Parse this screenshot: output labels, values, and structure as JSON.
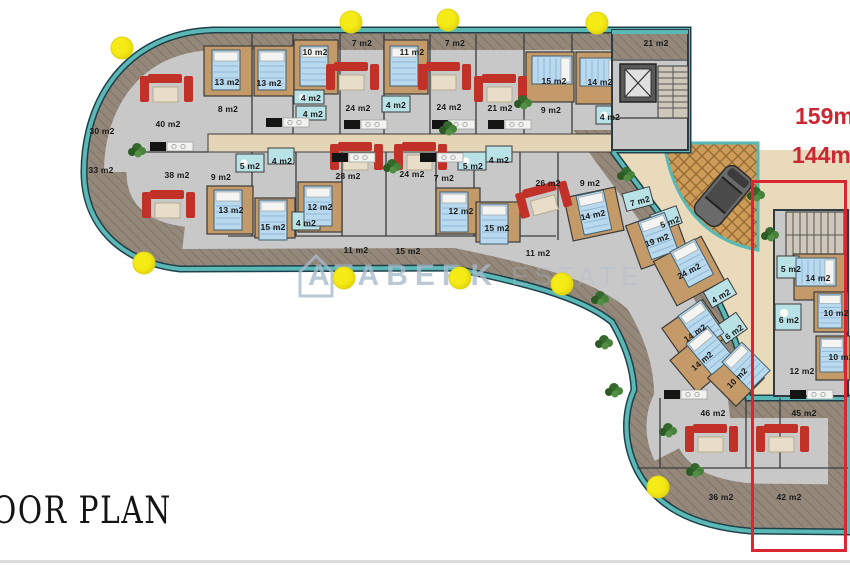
{
  "title": {
    "floor_plan": "OOR PLAN"
  },
  "watermark": {
    "brand": "ATABERK",
    "suffix": "ESTATE"
  },
  "highlight": {
    "area_line1": "159m",
    "area_line2": "144m"
  },
  "colors": {
    "teal_edge": "#5ab9b7",
    "dark_outline": "#2e3b42",
    "floor_grey": "#c8c8c8",
    "deck_wood": "#94887b",
    "room_wood": "#c49a68",
    "bath_cyan": "#b9e2e6",
    "pavement_beige": "#e9dabc",
    "court_pattern": "#cd9c58",
    "sofa_red": "#c23128",
    "dot_yellow": "#f5eb16",
    "highlight_red": "#da2630",
    "watermark_blue": "#a9bacd"
  },
  "rooms": [
    {
      "t": "30 m2",
      "x": 102,
      "y": 131
    },
    {
      "t": "33 m2",
      "x": 101,
      "y": 170
    },
    {
      "t": "7 m2",
      "x": 362,
      "y": 43
    },
    {
      "t": "7 m2",
      "x": 455,
      "y": 43
    },
    {
      "t": "21 m2",
      "x": 656,
      "y": 43
    },
    {
      "t": "11 m2",
      "x": 356,
      "y": 250
    },
    {
      "t": "15 m2",
      "x": 408,
      "y": 251
    },
    {
      "t": "11 m2",
      "x": 538,
      "y": 253
    },
    {
      "t": "36 m2",
      "x": 721,
      "y": 497
    },
    {
      "t": "42 m2",
      "x": 789,
      "y": 497
    },
    {
      "t": "40 m2",
      "x": 168,
      "y": 124
    },
    {
      "t": "13 m2",
      "x": 227,
      "y": 82
    },
    {
      "t": "13 m2",
      "x": 269,
      "y": 83
    },
    {
      "t": "8 m2",
      "x": 228,
      "y": 109
    },
    {
      "t": "10 m2",
      "x": 315,
      "y": 52
    },
    {
      "t": "4 m2",
      "x": 311,
      "y": 98
    },
    {
      "t": "4 m2",
      "x": 313,
      "y": 114
    },
    {
      "t": "24 m2",
      "x": 358,
      "y": 108
    },
    {
      "t": "11 m2",
      "x": 412,
      "y": 52
    },
    {
      "t": "4 m2",
      "x": 396,
      "y": 105
    },
    {
      "t": "24 m2",
      "x": 449,
      "y": 107
    },
    {
      "t": "21 m2",
      "x": 500,
      "y": 108
    },
    {
      "t": "9 m2",
      "x": 551,
      "y": 110
    },
    {
      "t": "15 m2",
      "x": 554,
      "y": 81
    },
    {
      "t": "14 m2",
      "x": 600,
      "y": 82
    },
    {
      "t": "4 m2",
      "x": 610,
      "y": 117
    },
    {
      "t": "38 m2",
      "x": 177,
      "y": 175
    },
    {
      "t": "9 m2",
      "x": 221,
      "y": 177
    },
    {
      "t": "5 m2",
      "x": 250,
      "y": 166
    },
    {
      "t": "4 m2",
      "x": 282,
      "y": 161
    },
    {
      "t": "13 m2",
      "x": 231,
      "y": 210
    },
    {
      "t": "15 m2",
      "x": 273,
      "y": 227
    },
    {
      "t": "4 m2",
      "x": 306,
      "y": 223
    },
    {
      "t": "12 m2",
      "x": 320,
      "y": 207
    },
    {
      "t": "28 m2",
      "x": 348,
      "y": 176
    },
    {
      "t": "24 m2",
      "x": 412,
      "y": 174
    },
    {
      "t": "7 m2",
      "x": 444,
      "y": 178
    },
    {
      "t": "5 m2",
      "x": 473,
      "y": 166
    },
    {
      "t": "4 m2",
      "x": 499,
      "y": 160
    },
    {
      "t": "12 m2",
      "x": 461,
      "y": 211
    },
    {
      "t": "15 m2",
      "x": 497,
      "y": 228
    },
    {
      "t": "26 m2",
      "x": 548,
      "y": 183
    },
    {
      "t": "9 m2",
      "x": 590,
      "y": 183
    },
    {
      "t": "7 m2",
      "x": 640,
      "y": 201,
      "r": -15
    },
    {
      "t": "5 m2",
      "x": 670,
      "y": 222,
      "r": -20
    },
    {
      "t": "14 m2",
      "x": 593,
      "y": 215,
      "r": -12
    },
    {
      "t": "19 m2",
      "x": 657,
      "y": 240,
      "r": -20
    },
    {
      "t": "24 m2",
      "x": 689,
      "y": 271,
      "r": -28
    },
    {
      "t": "4 m2",
      "x": 721,
      "y": 296,
      "r": -30
    },
    {
      "t": "14 m2",
      "x": 695,
      "y": 333,
      "r": -35
    },
    {
      "t": "6 m2",
      "x": 734,
      "y": 332,
      "r": -35
    },
    {
      "t": "14 m2",
      "x": 702,
      "y": 361,
      "r": -40
    },
    {
      "t": "10 m2",
      "x": 737,
      "y": 378,
      "r": -45
    },
    {
      "t": "46 m2",
      "x": 713,
      "y": 413
    },
    {
      "t": "45 m2",
      "x": 804,
      "y": 413
    },
    {
      "t": "5 m2",
      "x": 791,
      "y": 269
    },
    {
      "t": "14 m2",
      "x": 818,
      "y": 278
    },
    {
      "t": "6 m2",
      "x": 789,
      "y": 320
    },
    {
      "t": "10 m2",
      "x": 836,
      "y": 313
    },
    {
      "t": "10 m2",
      "x": 841,
      "y": 357
    },
    {
      "t": "12 m2",
      "x": 802,
      "y": 371
    }
  ],
  "dots": [
    {
      "x": 122,
      "y": 48
    },
    {
      "x": 351,
      "y": 22
    },
    {
      "x": 448,
      "y": 20
    },
    {
      "x": 597,
      "y": 23
    },
    {
      "x": 144,
      "y": 263
    },
    {
      "x": 344,
      "y": 278
    },
    {
      "x": 460,
      "y": 278
    },
    {
      "x": 562,
      "y": 284
    },
    {
      "x": 658,
      "y": 487
    }
  ]
}
